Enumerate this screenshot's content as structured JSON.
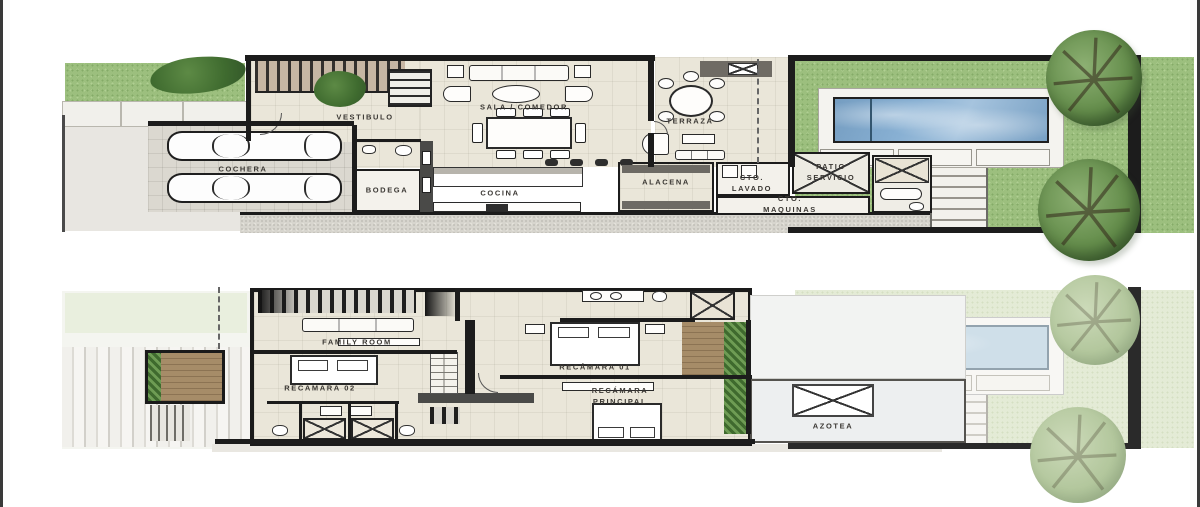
{
  "document": {
    "type": "residential floor plans",
    "levels": 2
  },
  "plans": {
    "ground": {
      "rooms": {
        "vestibulo": "VESTIBULO",
        "cochera": "COCHERA",
        "bodega": "BODEGA",
        "sala_comedor": "SALA / COMEDOR",
        "cocina": "COCINA",
        "alacena": "ALACENA",
        "terraza": "TERRAZA",
        "cto_lavado": "CTO.\nLAVADO",
        "patio_servicio": "PATIO\nSERVICIO",
        "cto_maquinas": "CTO.\nMAQUINAS"
      },
      "features": {
        "cars": 2,
        "pool": 1,
        "trees": 2
      }
    },
    "upper": {
      "rooms": {
        "family_room": "FAMILY ROOM",
        "recamara_02": "RECÁMARA 02",
        "recamara_01": "RECÁMARA 01",
        "recamara_principal": "RECÁMARA\nPRINCIPAL",
        "azotea": "AZOTEA"
      },
      "features": {
        "ghost_pool": 1,
        "ghost_trees": 2
      }
    }
  },
  "colors": {
    "wall": "#1c1c1c",
    "floor": "#eae6d9",
    "grass": "#9cbf7e",
    "grass_pale": "#e4ebd6",
    "pool": "#88b0d3",
    "pool_pale": "#cfdfe9",
    "gravel": "#d7d5ce",
    "wood": "#a68c68",
    "planter": "#517d3b"
  }
}
